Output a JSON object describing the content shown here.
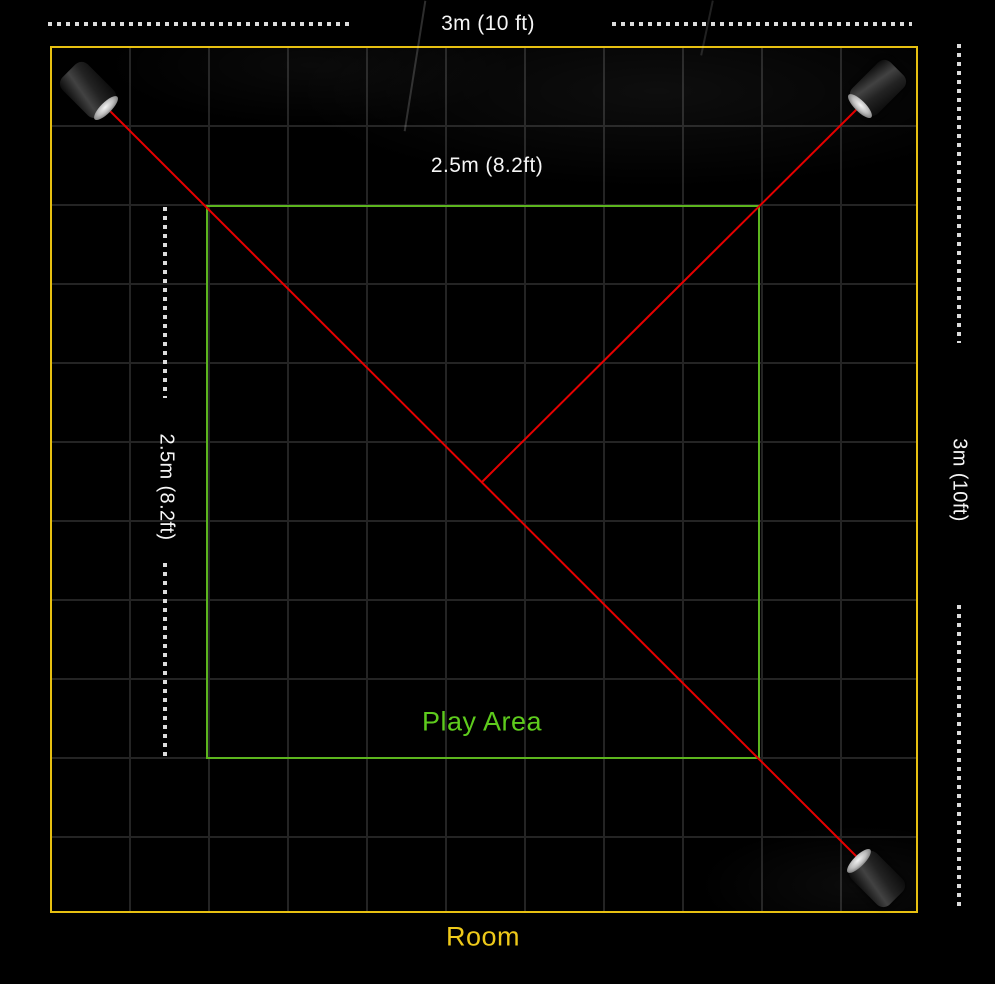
{
  "diagram": {
    "room": {
      "label": "Room",
      "width_label": "3m (10 ft)",
      "height_label": "3m (10ft)"
    },
    "play_area": {
      "label": "Play Area",
      "width_label": "2.5m (8.2ft)",
      "height_label": "2.5m (8.2ft)"
    },
    "base_stations": [
      {
        "id": "top-left",
        "icon": "base-station-icon"
      },
      {
        "id": "top-right",
        "icon": "base-station-icon"
      },
      {
        "id": "bottom-right",
        "icon": "base-station-icon"
      }
    ]
  },
  "colors": {
    "background": "#000000",
    "room": "#e7c011",
    "room_text": "#eec91a",
    "play_area": "#5cb51e",
    "play_area_text": "#5ecb1d",
    "laser": "#e60000",
    "dash": "#dcdcdc",
    "dimension_text": "#f5f5f5",
    "grid_line": "#242424"
  }
}
